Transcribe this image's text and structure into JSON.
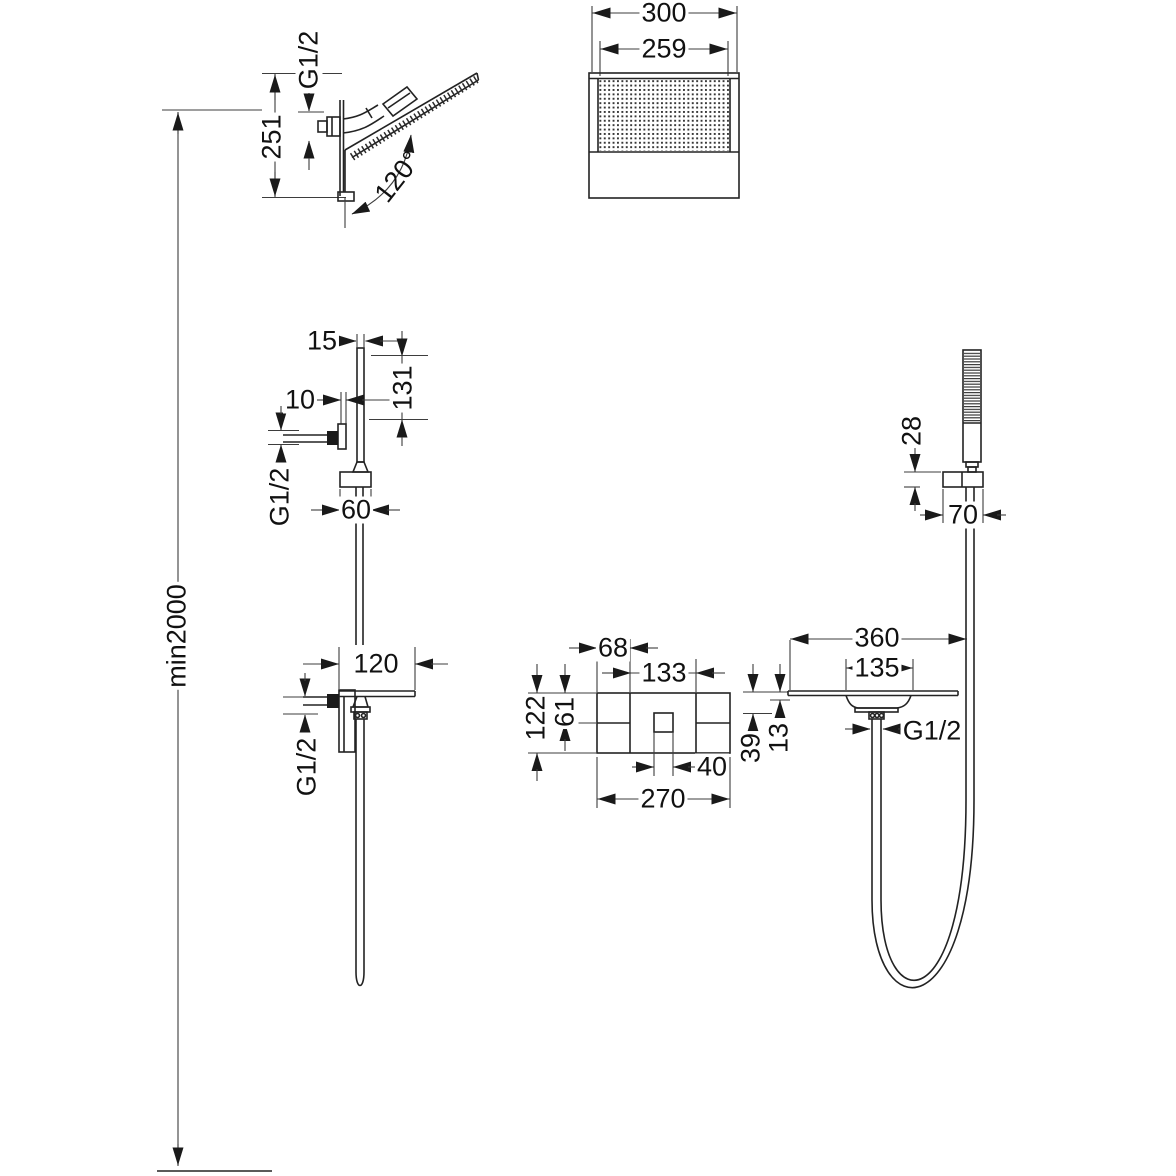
{
  "style": {
    "background": "#ffffff",
    "line_color": "#232323",
    "text_color": "#111111"
  },
  "installation": {
    "min_mounting_height": "min2000"
  },
  "views": {
    "overhead_shower_side": {
      "name": "waterfall-head-side-view",
      "dims": {
        "connection": "G1/2",
        "height": "251",
        "angle": "120°"
      }
    },
    "overhead_shower_front": {
      "name": "waterfall-head-front-view",
      "dims": {
        "width": "300",
        "spray_width": "259"
      }
    },
    "hand_shower_holder_side": {
      "name": "holder-column-side-view",
      "dims": {
        "thickness": "15",
        "length": "131",
        "bracket": "10",
        "connection": "G1/2",
        "escutcheon_width": "60"
      }
    },
    "spout_side": {
      "name": "shelf-spout-side-view",
      "dims": {
        "projection": "120",
        "connection": "G1/2"
      }
    },
    "valve_front": {
      "name": "concealed-valve-front-view",
      "dims": {
        "left_section": "68",
        "center_section": "133",
        "height": "122",
        "upper_height": "61",
        "handle_width": "40",
        "width": "270"
      }
    },
    "shelf_front": {
      "name": "shelf-spout-front-view",
      "dims": {
        "width": "360",
        "funnel_width": "135",
        "offset_39": "39",
        "lip_13": "13",
        "hose_connection": "G1/2"
      }
    },
    "hand_shower_front": {
      "name": "hand-shower-front-view",
      "dims": {
        "holder_height": "28",
        "holder_width": "70"
      }
    }
  }
}
